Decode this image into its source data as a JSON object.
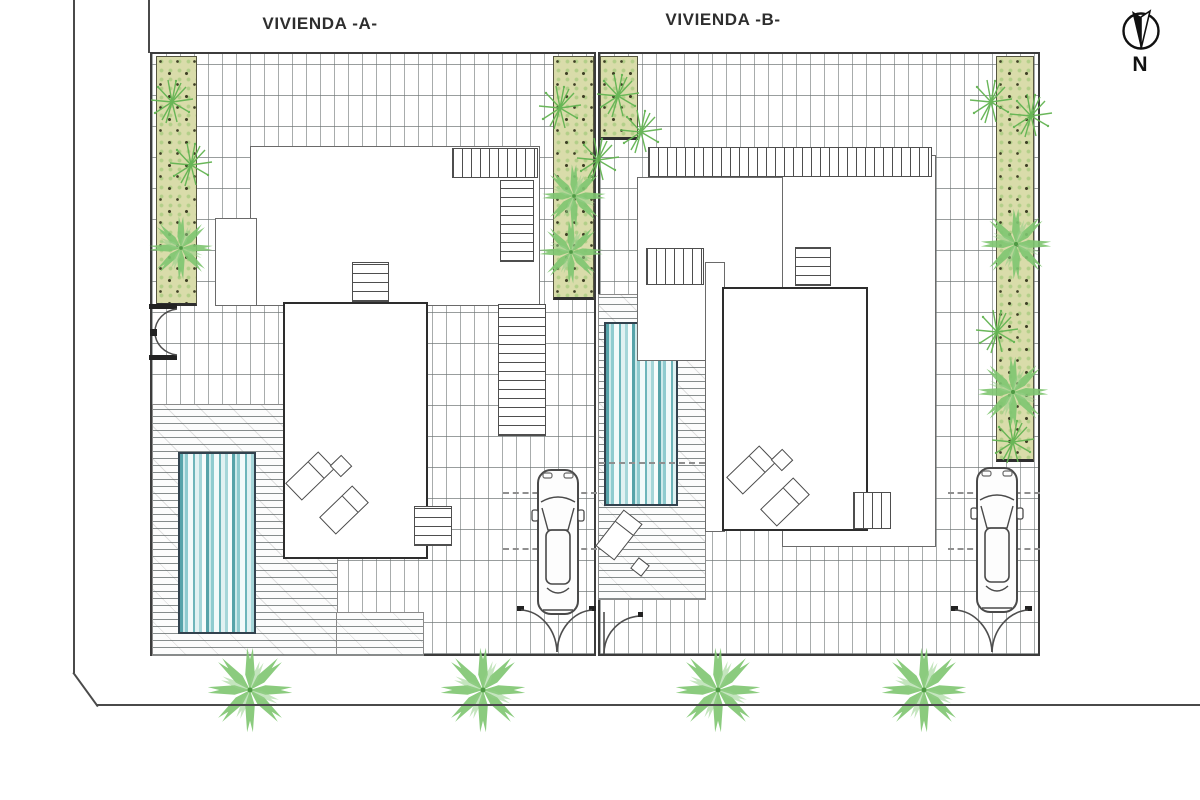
{
  "drawing": {
    "type": "site-plan",
    "titles": {
      "plot_a": "VIVIENDA -A-",
      "plot_b": "VIVIENDA -B-"
    },
    "compass": {
      "label": "N",
      "direction": "south-up"
    }
  },
  "plots": [
    {
      "id": "A",
      "label": "VIVIENDA -A-",
      "features": [
        "house-roof-plan",
        "exterior-stairs",
        "swimming-pool",
        "wood-deck",
        "sun-loungers",
        "parked-car",
        "driveway-double-gate",
        "pedestrian-gate",
        "planting-strips",
        "tiled-paving"
      ]
    },
    {
      "id": "B",
      "label": "VIVIENDA -B-",
      "features": [
        "house-roof-plan",
        "exterior-stairs",
        "swimming-pool",
        "wood-deck",
        "sun-loungers",
        "parked-car",
        "driveway-double-gate",
        "pedestrian-gate",
        "planting-strips",
        "tiled-paving"
      ]
    }
  ],
  "site": {
    "street_palm_count": 4,
    "sidewalk": true,
    "chamfered_corner": "bottom-left"
  },
  "palette": {
    "paving_line": "#6e7474",
    "planting_strip_fill": "#d9dcaa",
    "plant_green": "#6fbf5f",
    "palm_green": "#7fc671",
    "pool_teal_dark": "#57a3a9",
    "pool_teal_light": "#cde9ea",
    "house_outline": "#2d2d2d",
    "boundary_line": "#4a4a4a"
  },
  "icons": [
    "north-arrow-icon",
    "palm-tree-icon",
    "shrub-icon",
    "car-top-view-icon",
    "gate-arc-icon"
  ]
}
